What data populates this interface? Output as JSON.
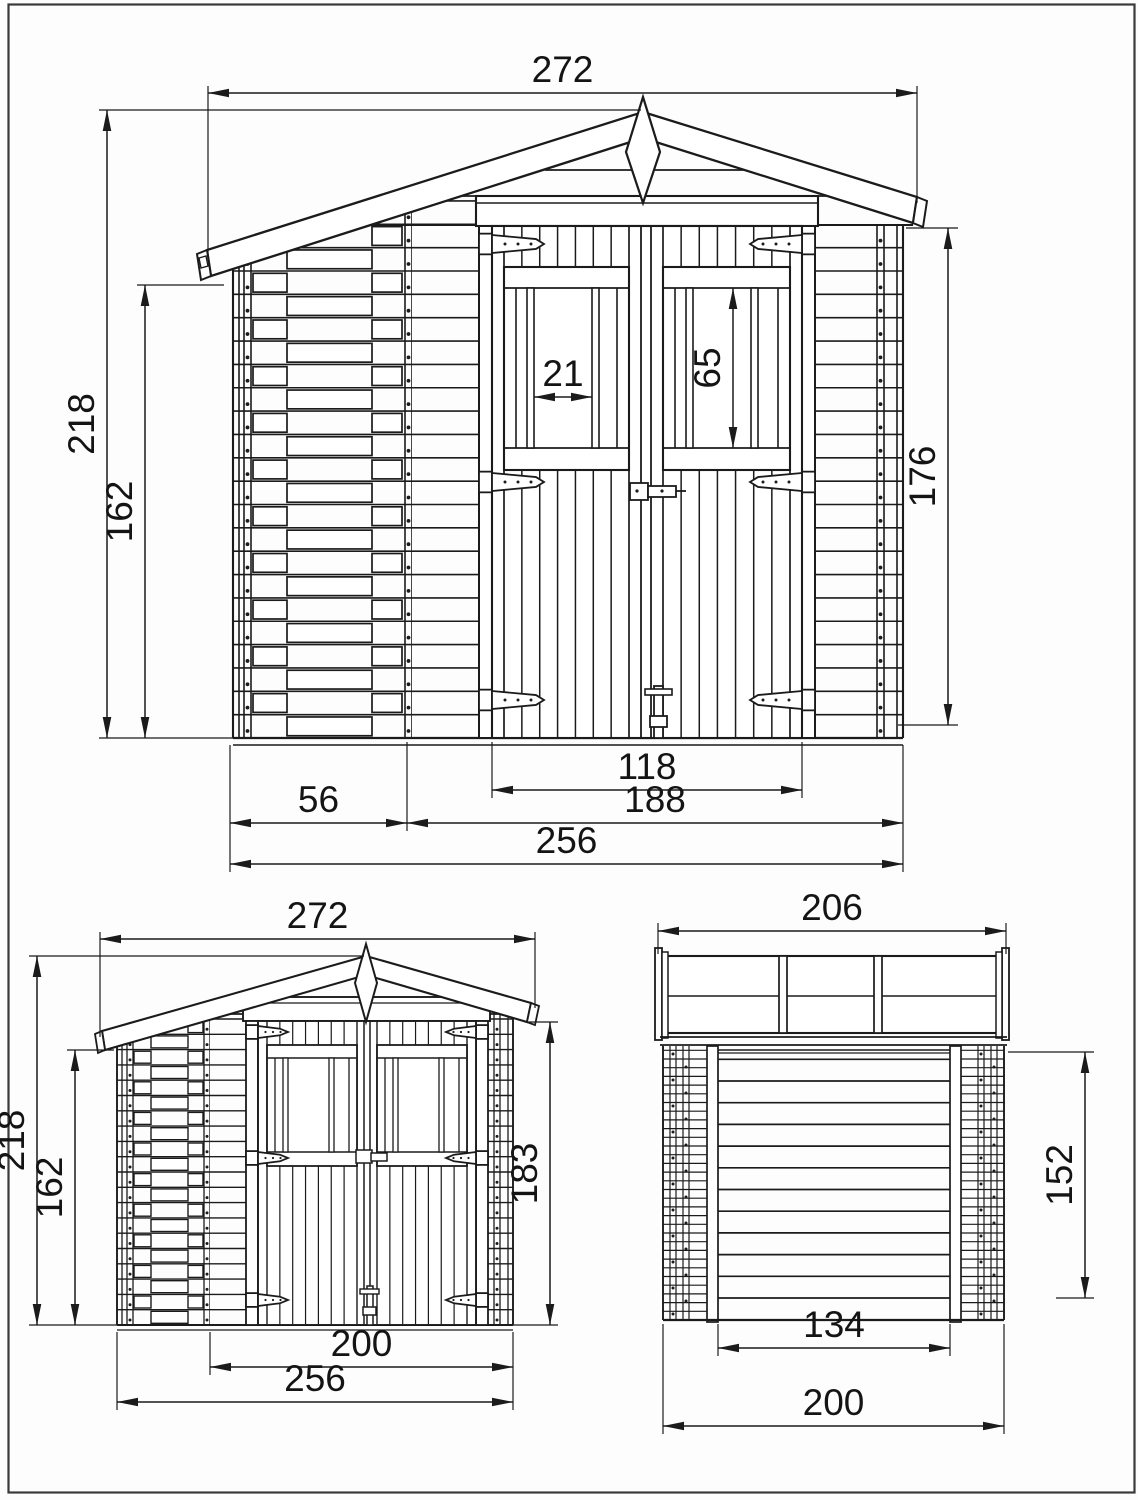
{
  "drawing": {
    "title": "Wooden garden shed — dimensioned technical drawing (cm)",
    "views": {
      "front_large": {
        "name": "front elevation (detailed)",
        "dims": {
          "roof_width": "272",
          "total_height": "218",
          "left_wall_height": "162",
          "window_pane_width": "21",
          "window_height": "65",
          "right_wall_height": "176",
          "door_width": "118",
          "left_bay_width": "56",
          "door_bay_width": "188",
          "base_width": "256"
        }
      },
      "front_small": {
        "name": "front elevation (overview)",
        "dims": {
          "roof_width": "272",
          "total_height": "218",
          "left_wall_height": "162",
          "eave_height": "183",
          "door_bay_width": "200",
          "base_width": "256"
        }
      },
      "side": {
        "name": "side elevation",
        "dims": {
          "roof_depth": "206",
          "wall_height": "152",
          "inner_span": "134",
          "base_depth": "200"
        }
      }
    }
  }
}
